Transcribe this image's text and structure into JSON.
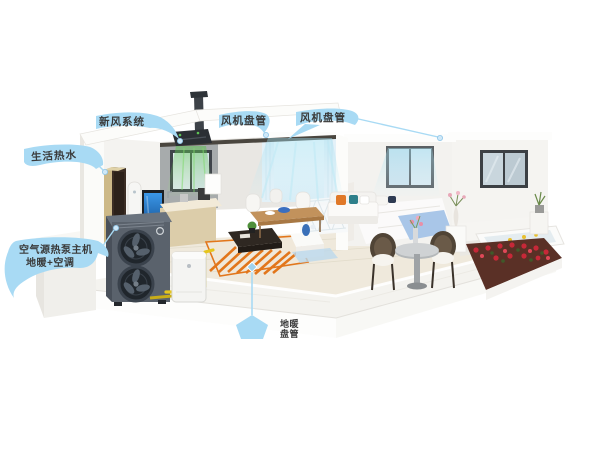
{
  "scene": {
    "title": "heat-pump-house-cutaway",
    "background": "#ffffff"
  },
  "palette": {
    "callout_blue": "#a8daf4",
    "label_text": "#3a3a3a",
    "floor_coil_orange": "#e2761b",
    "pipe_yellow": "#e5c51e",
    "fresh_air_green": "#5fc455",
    "ac_air_cyan": "#9fdff0",
    "outdoor_unit_gray": "#5a626c",
    "flower_red": "#c62838",
    "bed_throw_blue": "#a9c6e8"
  },
  "callouts": {
    "fresh_air": {
      "label": "新风系统",
      "target": "ceiling-fresh-air-unit"
    },
    "fan_coil_living": {
      "label": "风机盘管",
      "target": "living-ceiling-vent"
    },
    "fan_coil_bedroom": {
      "label": "风机盘管",
      "target": "bedroom-ceiling-vent"
    },
    "hot_water": {
      "label": "生活热水",
      "target": "water-heater-cabinet"
    },
    "heat_pump": {
      "label_line1": "空气源热泵主机",
      "label_line2": "地暖+空调",
      "target": "outdoor-heat-pump-unit"
    },
    "floor_heating": {
      "label_line1": "地暖",
      "label_line2": "盘管",
      "target": "floor-heating-coil"
    }
  },
  "components": [
    "outdoor-heat-pump-unit",
    "buffer-tank",
    "water-heater-cabinet",
    "ceiling-fresh-air-unit",
    "roof-exhaust-pipe",
    "floor-heating-coil",
    "kitchen-window",
    "dining-window",
    "bedroom-window",
    "patio-furniture",
    "bathtub",
    "flower-bed"
  ]
}
